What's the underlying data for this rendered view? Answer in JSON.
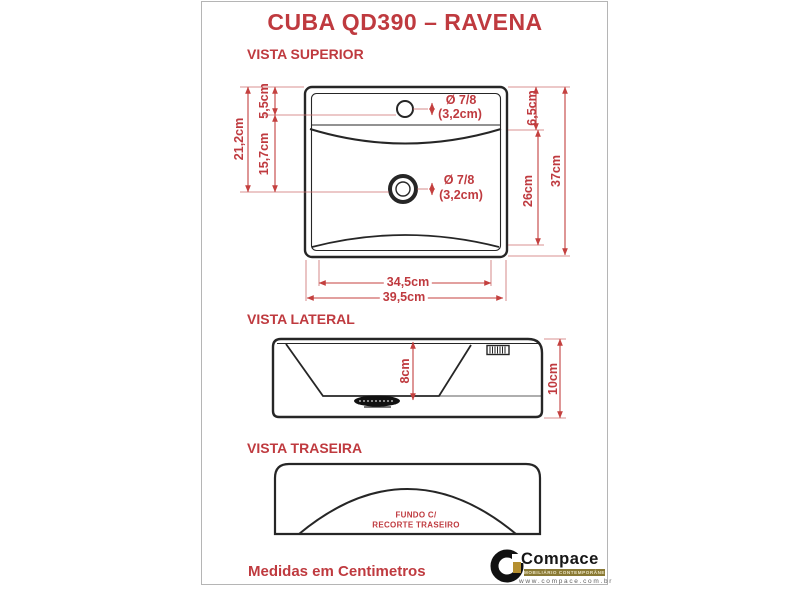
{
  "page": {
    "title": "CUBA QD390 – RAVENA",
    "footer_note": "Medidas em Centimetros"
  },
  "colors": {
    "accent_red": "#bf3a3f",
    "line_black": "#262626",
    "border_gray": "#b5b5b5",
    "logo_gold": "#b58f2f"
  },
  "views": {
    "superior": {
      "heading": "VISTA SUPERIOR",
      "dims": {
        "left_total": "21,2cm",
        "left_top": "5,5cm",
        "left_bottom": "15,7cm",
        "right_top": "6,5cm",
        "right_mid": "26cm",
        "right_total": "37cm",
        "bottom_inner": "34,5cm",
        "bottom_outer": "39,5cm"
      },
      "faucet_hole": {
        "diameter_line1": "Ø 7/8",
        "diameter_line2": "(3,2cm)"
      },
      "drain_hole": {
        "diameter_line1": "Ø 7/8",
        "diameter_line2": "(3,2cm)"
      }
    },
    "lateral": {
      "heading": "VISTA LATERAL",
      "dims": {
        "inner_depth": "8cm",
        "outer_height": "10cm"
      }
    },
    "traseira": {
      "heading": "VISTA TRASEIRA",
      "note_line1": "FUNDO C/",
      "note_line2": "RECORTE TRASEIRO"
    }
  },
  "logo": {
    "name": "Compace",
    "tagline": "MOBILIÁRIO CONTEMPORÂNEO",
    "website": "www.compace.com.br"
  }
}
